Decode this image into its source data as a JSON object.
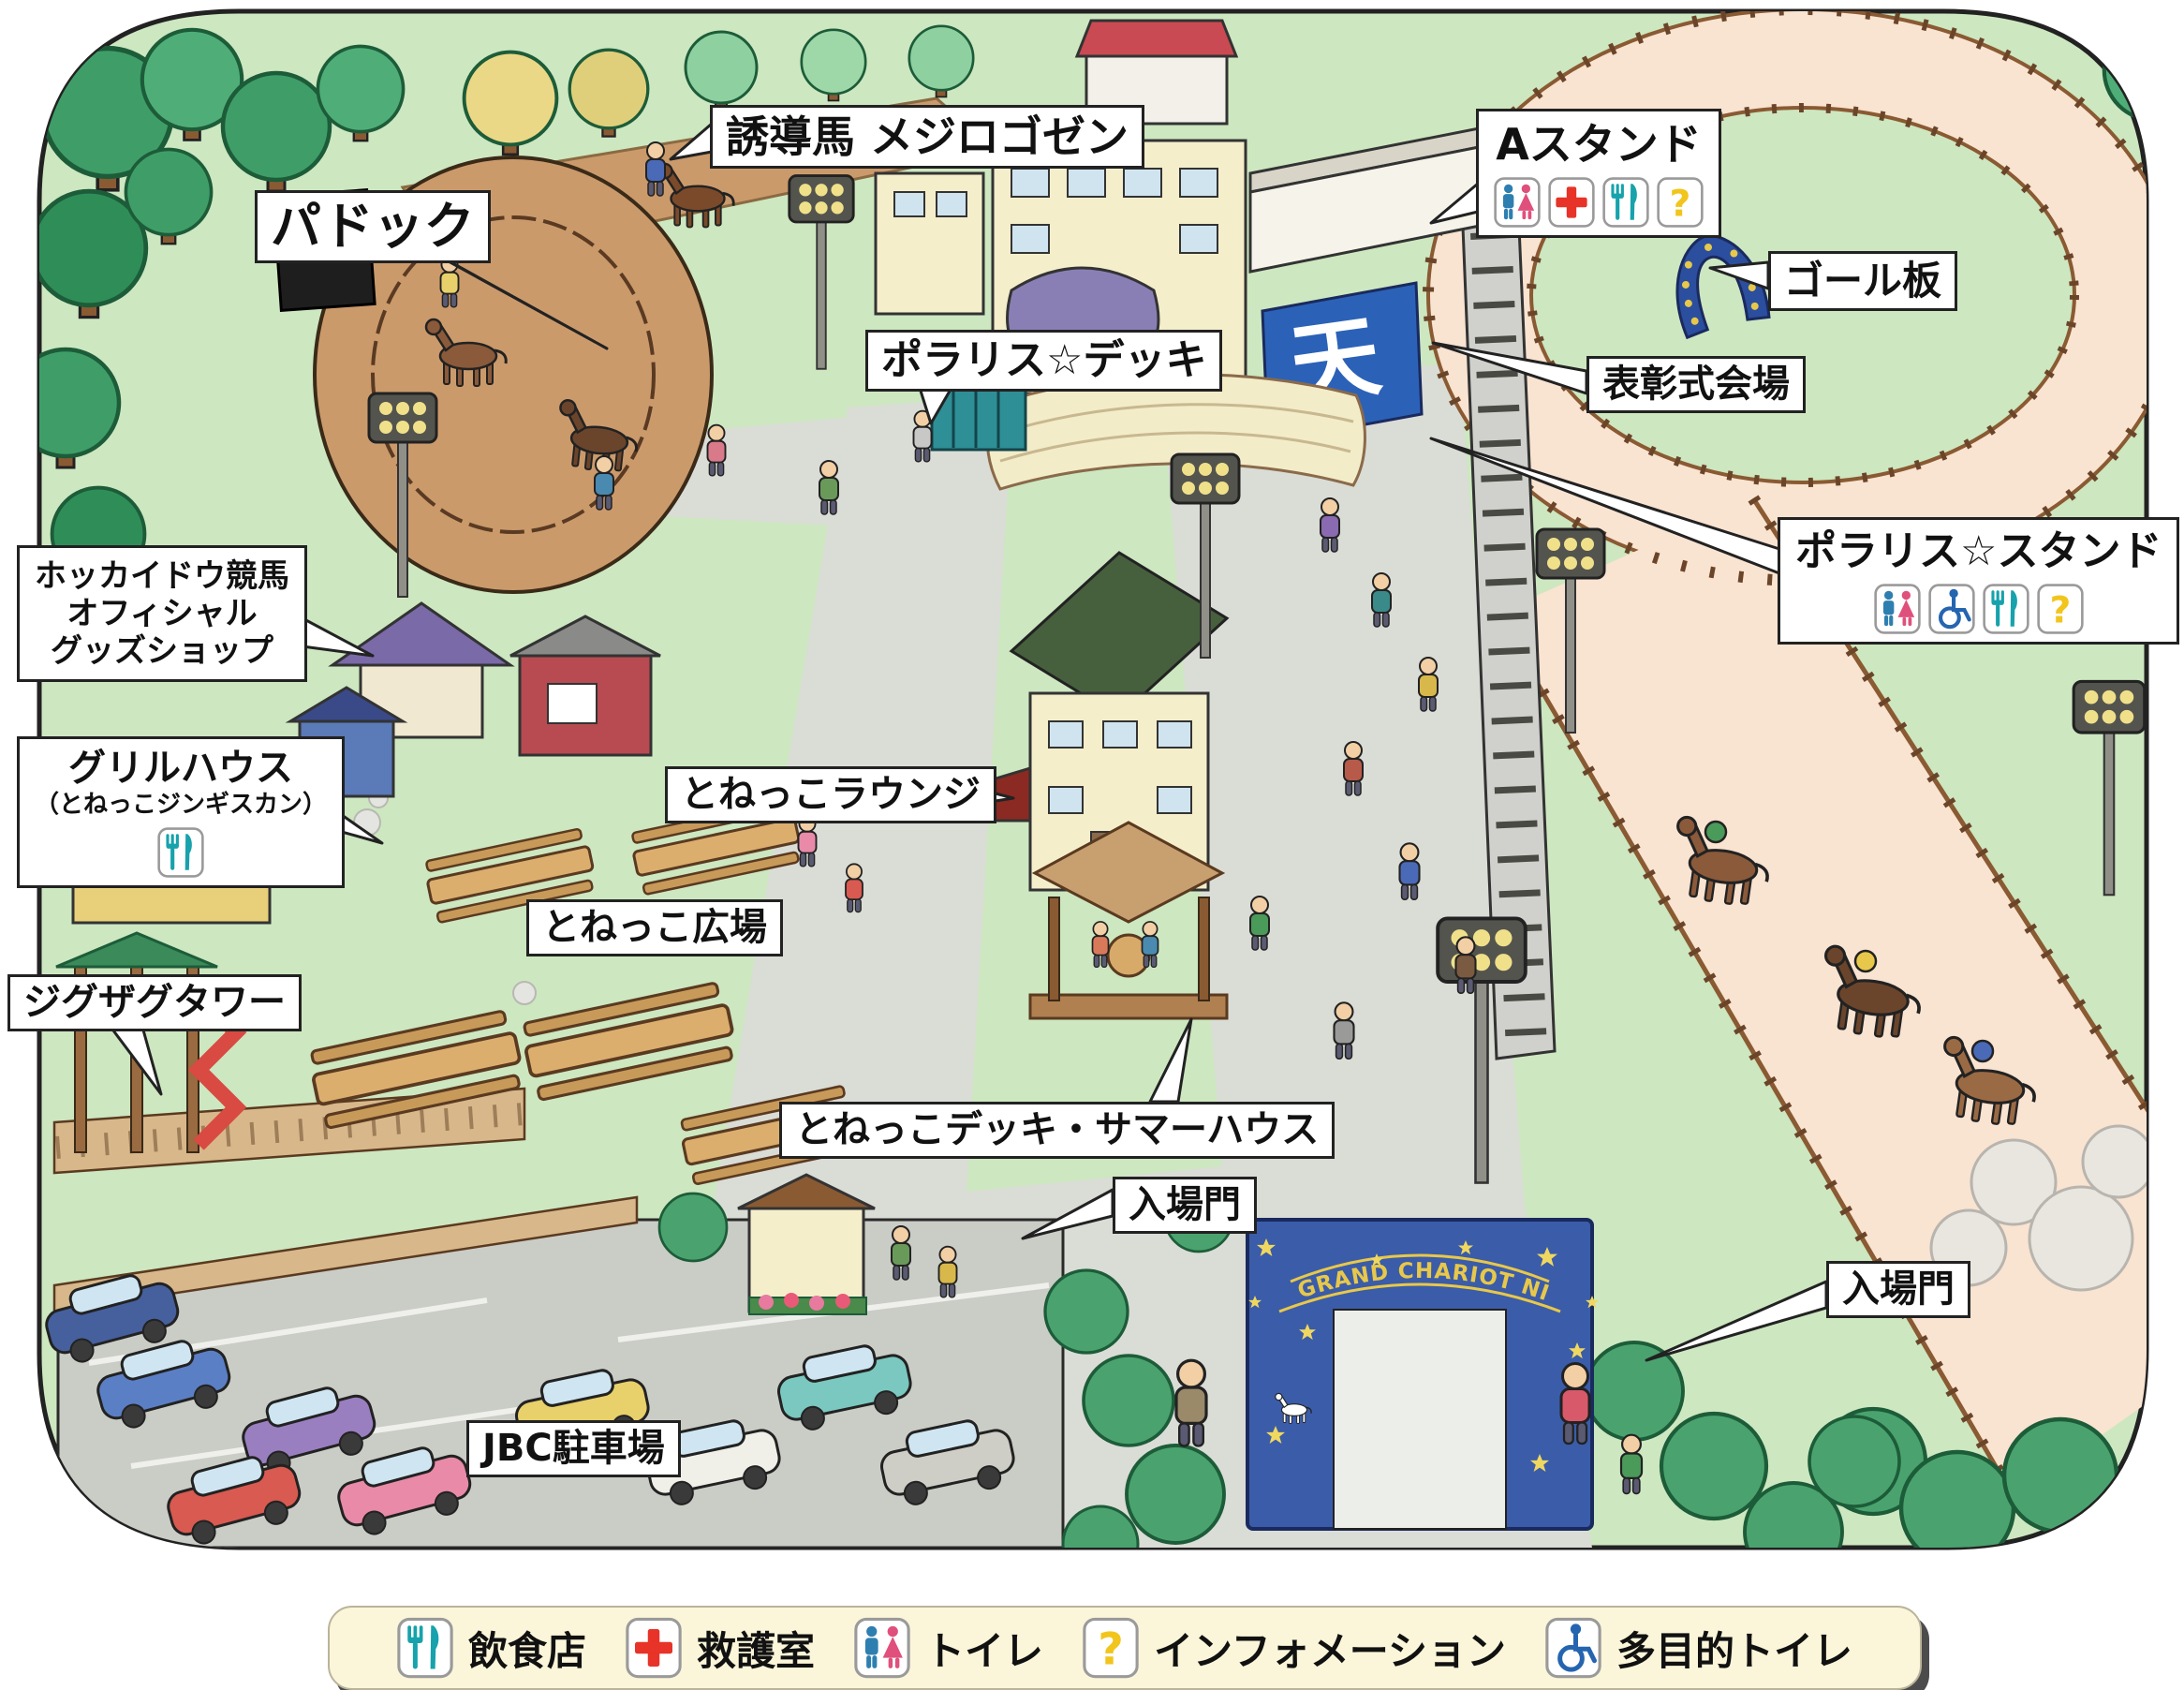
{
  "map": {
    "colors": {
      "grass": "#cde7c0",
      "tree_green": "#3f9e68",
      "track_dirt": "#f9e3d1",
      "path_gray": "#dadcd6",
      "paddock_dirt": "#cb9a6b",
      "label_bg": "#ffffff",
      "label_border": "#222222",
      "legend_bg": "#fbf6d9",
      "gate_blue": "#3b5ca8",
      "icon_restaurant": "#17a2ac",
      "icon_first_aid": "#e73328",
      "icon_man": "#2e7fb0",
      "icon_woman": "#e0507c",
      "icon_information": "#f2c51d",
      "icon_wheelchair": "#2565b0"
    }
  },
  "labels": {
    "guide_horse": "誘導馬 メジロゴゼン",
    "paddock": "パドック",
    "a_stand": "Aスタンド",
    "goal_board": "ゴール板",
    "award_ceremony": "表彰式会場",
    "polaris_deck": "ポラリス☆デッキ",
    "polaris_stand": "ポラリス☆スタンド",
    "goods_shop_line1": "ホッカイドウ競馬",
    "goods_shop_line2": "オフィシャル",
    "goods_shop_line3": "グッズショップ",
    "grill_house": "グリルハウス",
    "grill_house_sub": "（とねっこジンギスカン）",
    "zigzag_tower": "ジグザグタワー",
    "tonekko_lounge": "とねっこラウンジ",
    "tonekko_plaza": "とねっこ広場",
    "tonekko_deck_summer_house": "とねっこデッキ・サマーハウス",
    "entrance_gate_left": "入場門",
    "entrance_gate_right": "入場門",
    "jbc_parking": "JBC駐車場"
  },
  "gate": {
    "banner_text": "GRAND CHARIOT NIGHTER"
  },
  "big_screen": {
    "text": "天"
  },
  "facility_icons": {
    "a_stand": [
      "toilet",
      "first-aid",
      "restaurant",
      "information"
    ],
    "polaris_stand": [
      "toilet",
      "accessible-toilet",
      "restaurant",
      "information"
    ],
    "grill_house": [
      "restaurant"
    ]
  },
  "legend": {
    "items": [
      {
        "icon": "restaurant",
        "label": "飲食店"
      },
      {
        "icon": "first-aid",
        "label": "救護室"
      },
      {
        "icon": "toilet",
        "label": "トイレ"
      },
      {
        "icon": "information",
        "label": "インフォメーション"
      },
      {
        "icon": "accessible-toilet",
        "label": "多目的トイレ"
      }
    ]
  }
}
